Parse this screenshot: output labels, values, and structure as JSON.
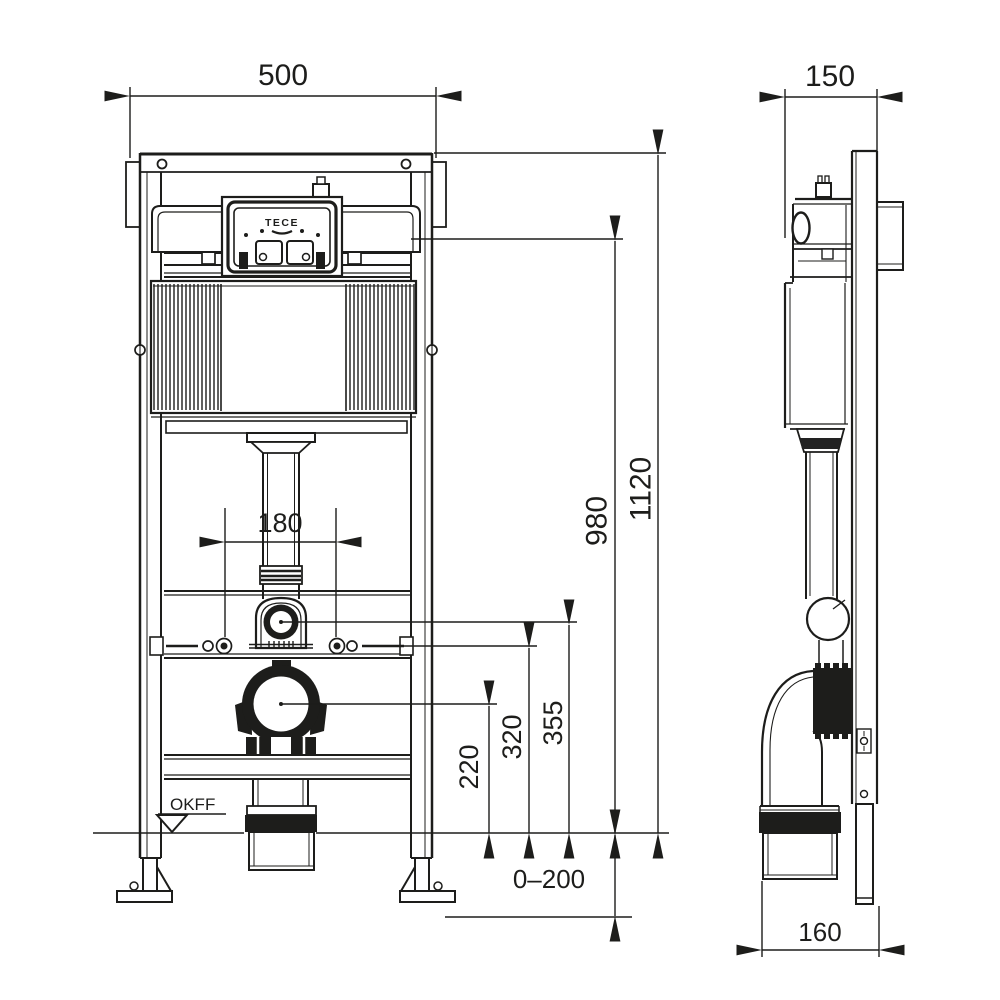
{
  "drawing": {
    "brand_logo": "TECE",
    "floor_level_label": "OKFF",
    "dimensions_mm": {
      "frame_width": "500",
      "frame_depth": "150",
      "frame_height": "1120",
      "cistern_top_height": "980",
      "flush_bend_center_height": "355",
      "fixing_bolt_height": "320",
      "waste_outlet_height": "220",
      "bolt_spacing": "180",
      "foot_adjustment_range": "0–200",
      "waste_bend_depth": "160"
    },
    "colors": {
      "line": "#1d1d1b",
      "background": "#ffffff"
    }
  }
}
